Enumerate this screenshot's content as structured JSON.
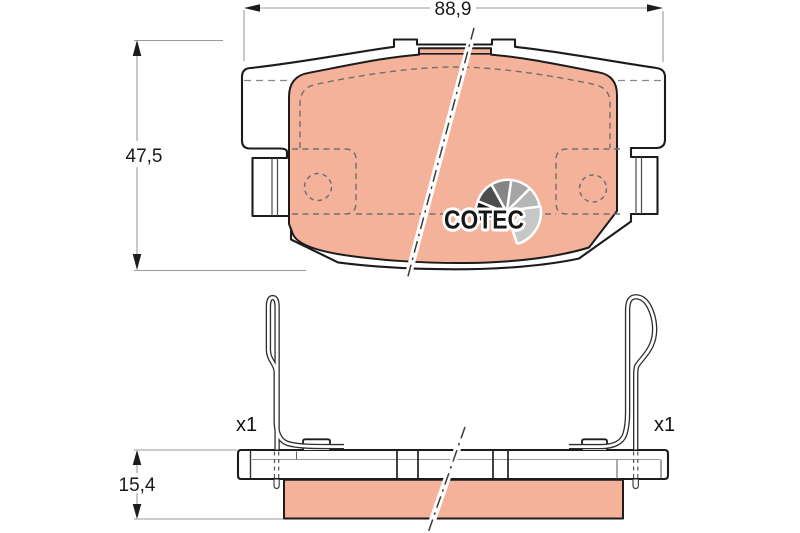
{
  "drawing_labels": {
    "width_dim": "88,9",
    "height_dim": "47,5",
    "thickness_dim": "15,4",
    "left_qty": "x1",
    "right_qty": "x1"
  },
  "logo": {
    "text": "COTEC",
    "wedges": [
      "#141414",
      "#4d4d4d",
      "#858585",
      "#a5a5a5",
      "#b6b6b6"
    ],
    "tail": "#c7c7c7"
  },
  "colors": {
    "friction": "#f4b29a",
    "outline": "#1c1c1c",
    "dimension_line": "#9a9a9a",
    "label_text": "#1a1a1a"
  }
}
